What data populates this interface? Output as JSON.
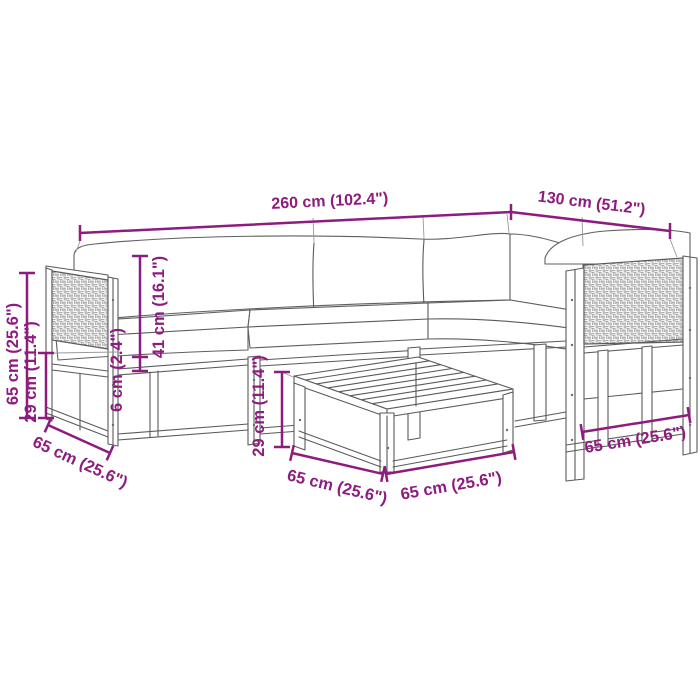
{
  "diagram": {
    "background": "#ffffff",
    "dimension_color": "#8d1c7e",
    "line_color": "#5a5a5a",
    "dimensions": {
      "total_width": "260 cm (102.4\")",
      "right_section_width": "130 cm (51.2\")",
      "overall_height": "65 cm (25.6\")",
      "seat_frame_height": "29 cm (11.4\")",
      "backrest_height": "41 cm (16.1\")",
      "cushion_thickness": "6 cm (2.4\")",
      "table_height": "29 cm (11.4\")",
      "sofa_depth": "65 cm (25.6\")",
      "table_depth": "65 cm (25.6\")",
      "table_width": "65 cm (25.6\")",
      "right_sofa_depth": "65 cm (25.6\")"
    }
  }
}
